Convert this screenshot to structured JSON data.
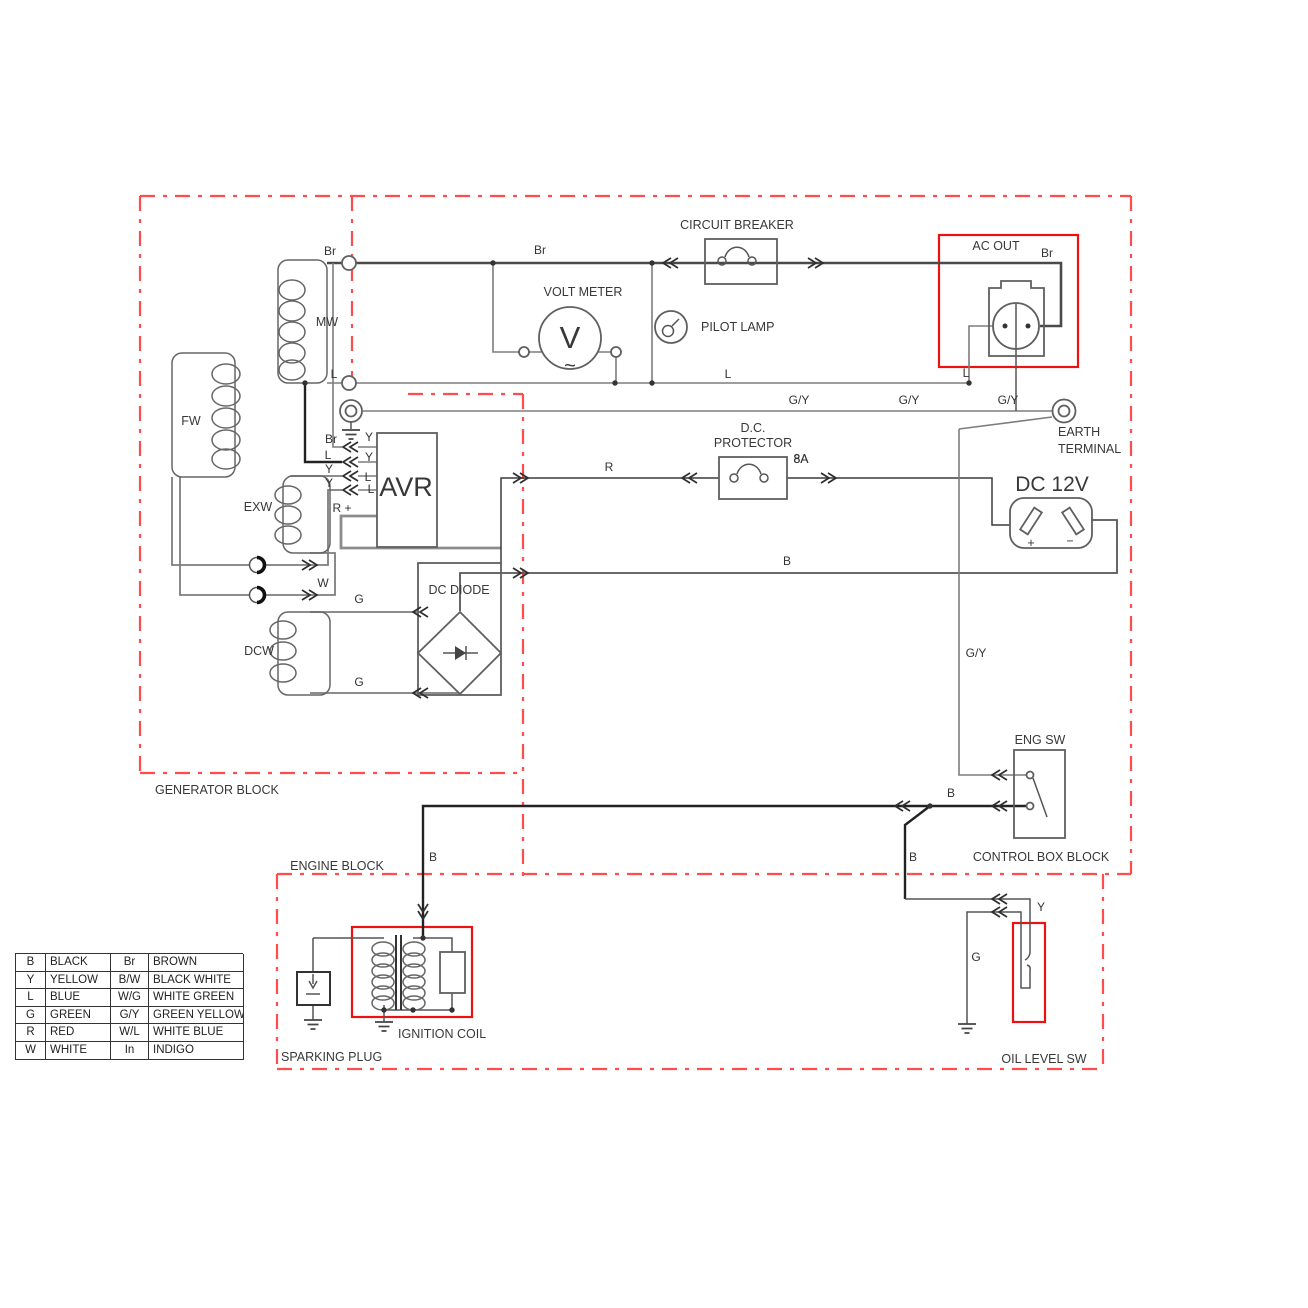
{
  "blocks": {
    "generator": "GENERATOR BLOCK",
    "engine": "ENGINE BLOCK",
    "control_box": "CONTROL BOX BLOCK"
  },
  "components": {
    "circuit_breaker": "CIRCUIT BREAKER",
    "volt_meter": "VOLT METER",
    "volt_meter_v": "V",
    "volt_meter_ac": "~",
    "pilot_lamp": "PILOT LAMP",
    "ac_out": "AC OUT",
    "earth_line1": "EARTH",
    "earth_line2": "TERMINAL",
    "dc_protector_l1": "D.C.",
    "dc_protector_l2": "PROTECTOR",
    "dc_protector_rating": "8A",
    "dc12v": "DC 12V",
    "dc12v_plus": "+",
    "dc12v_minus": "−",
    "dc_diode": "DC DIODE",
    "avr": "AVR",
    "eng_sw": "ENG SW",
    "ignition_coil": "IGNITION COIL",
    "sparking_plug": "SPARKING PLUG",
    "oil_level_sw": "OIL LEVEL SW",
    "coil_mw": "MW",
    "coil_fw": "FW",
    "coil_exw": "EXW",
    "coil_dcw": "DCW"
  },
  "wire_labels": [
    {
      "t": "Br",
      "x": 330,
      "y": 255
    },
    {
      "t": "Br",
      "x": 540,
      "y": 254
    },
    {
      "t": "Br",
      "x": 1047,
      "y": 257
    },
    {
      "t": "L",
      "x": 334,
      "y": 378
    },
    {
      "t": "L",
      "x": 728,
      "y": 378
    },
    {
      "t": "L",
      "x": 966,
      "y": 377
    },
    {
      "t": "G/Y",
      "x": 799,
      "y": 404
    },
    {
      "t": "G/Y",
      "x": 909,
      "y": 404
    },
    {
      "t": "G/Y",
      "x": 1008,
      "y": 404
    },
    {
      "t": "G/Y",
      "x": 976,
      "y": 657
    },
    {
      "t": "R",
      "x": 609,
      "y": 471
    },
    {
      "t": "R +",
      "x": 342,
      "y": 512
    },
    {
      "t": "B",
      "x": 787,
      "y": 565
    },
    {
      "t": "B",
      "x": 951,
      "y": 797
    },
    {
      "t": "B",
      "x": 913,
      "y": 861
    },
    {
      "t": "B",
      "x": 433,
      "y": 861
    },
    {
      "t": "W",
      "x": 323,
      "y": 587
    },
    {
      "t": "G",
      "x": 359,
      "y": 603
    },
    {
      "t": "G",
      "x": 359,
      "y": 686
    },
    {
      "t": "G",
      "x": 976,
      "y": 961
    },
    {
      "t": "Y",
      "x": 1041,
      "y": 911
    },
    {
      "t": "8A",
      "x": 801,
      "y": 463
    },
    {
      "t": "Br",
      "x": 331,
      "y": 443
    },
    {
      "t": "L",
      "x": 328,
      "y": 459
    },
    {
      "t": "Y",
      "x": 329,
      "y": 473
    },
    {
      "t": "Y",
      "x": 329,
      "y": 487
    },
    {
      "t": "Y",
      "x": 369,
      "y": 441
    },
    {
      "t": "Y",
      "x": 369,
      "y": 461
    },
    {
      "t": "L",
      "x": 368,
      "y": 481
    },
    {
      "t": "L",
      "x": 371,
      "y": 493
    }
  ],
  "connector_arrows": [
    {
      "d": "l",
      "x": 662,
      "y": 263
    },
    {
      "d": "r",
      "x": 824,
      "y": 263
    },
    {
      "d": "l",
      "x": 342,
      "y": 447
    },
    {
      "d": "l",
      "x": 342,
      "y": 462
    },
    {
      "d": "l",
      "x": 342,
      "y": 476
    },
    {
      "d": "l",
      "x": 342,
      "y": 490
    },
    {
      "d": "r",
      "x": 318,
      "y": 565
    },
    {
      "d": "r",
      "x": 318,
      "y": 595
    },
    {
      "d": "r",
      "x": 529,
      "y": 478
    },
    {
      "d": "l",
      "x": 681,
      "y": 478
    },
    {
      "d": "r",
      "x": 837,
      "y": 478
    },
    {
      "d": "r",
      "x": 529,
      "y": 573
    },
    {
      "d": "l",
      "x": 412,
      "y": 612
    },
    {
      "d": "l",
      "x": 412,
      "y": 693
    },
    {
      "d": "l",
      "x": 991,
      "y": 775
    },
    {
      "d": "l",
      "x": 991,
      "y": 806
    },
    {
      "d": "l",
      "x": 894,
      "y": 806
    },
    {
      "d": "l",
      "x": 991,
      "y": 899
    },
    {
      "d": "l",
      "x": 991,
      "y": 912
    },
    {
      "d": "u",
      "x": 423,
      "y": 920
    }
  ],
  "junction_dots": [
    [
      493,
      263
    ],
    [
      652,
      263
    ],
    [
      615,
      383
    ],
    [
      652,
      383
    ],
    [
      969,
      383
    ],
    [
      305,
      383
    ],
    [
      930,
      806
    ],
    [
      423,
      938
    ],
    [
      384,
      1010
    ],
    [
      413,
      1010
    ],
    [
      452,
      1010
    ]
  ],
  "legend": {
    "rows": [
      [
        "B",
        "BLACK",
        "Br",
        "BROWN"
      ],
      [
        "Y",
        "YELLOW",
        "B/W",
        "BLACK  WHITE"
      ],
      [
        "L",
        "BLUE",
        "W/G",
        "WHITE GREEN"
      ],
      [
        "G",
        "GREEN",
        "G/Y",
        "GREEN YELLOW"
      ],
      [
        "R",
        "RED",
        "W/L",
        "WHITE BLUE"
      ],
      [
        "W",
        "WHITE",
        "In",
        "INDIGO"
      ]
    ]
  },
  "colors": {
    "boundary": "#ff4d4d",
    "highlight": "#ee1111",
    "wire": "#7d7d7d",
    "text": "#383838"
  }
}
